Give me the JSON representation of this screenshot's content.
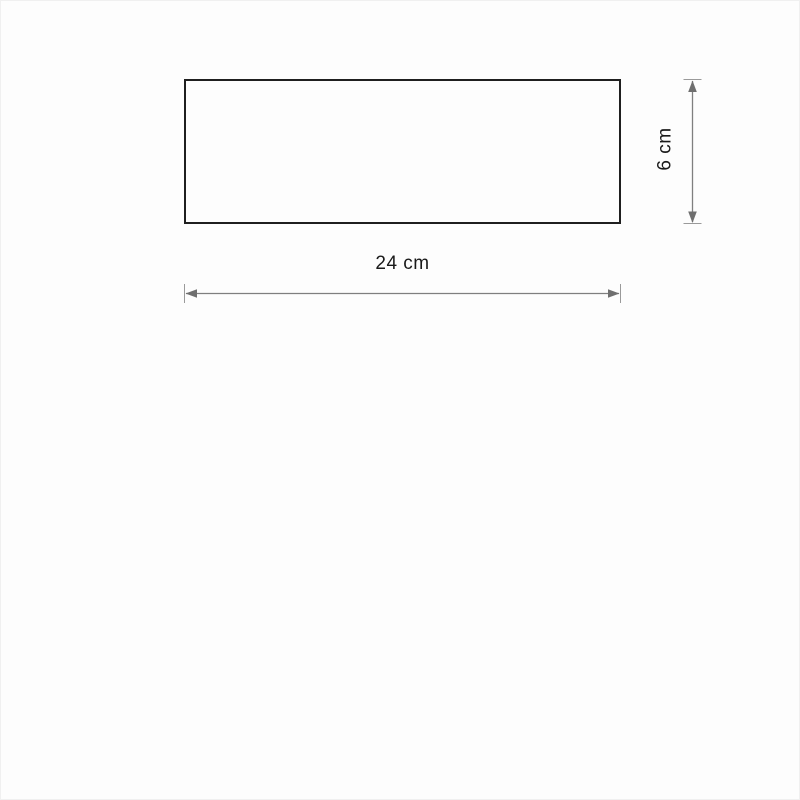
{
  "diagram": {
    "width_label": "24 cm",
    "height_label": "6 cm",
    "width_value_cm": 24,
    "height_value_cm": 6,
    "colors": {
      "background": "#fdfdfd",
      "outline": "#1f1f1f",
      "dimension_line": "#7f7f7f",
      "dimension_tick": "#9a9a9a",
      "arrowhead": "#6f6f6f",
      "text": "#1a1a1a"
    }
  }
}
